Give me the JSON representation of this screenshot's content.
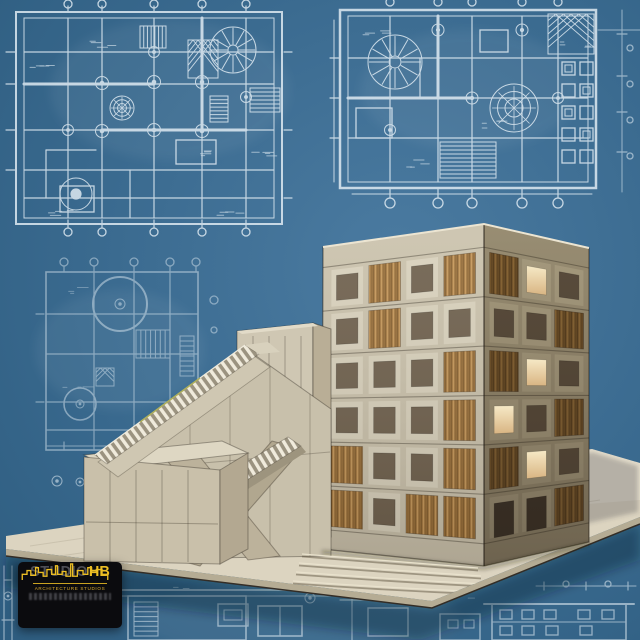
{
  "branding": {
    "studio": "STUDIO",
    "initials": "HB",
    "tagline": "ARCHITECTURE STUDIOS"
  },
  "palette": {
    "backdrop_top": "#4b7ba1",
    "backdrop_deep": "#2e5d80",
    "blueprint_line": "#e9f2f8",
    "concrete": "#d8d1bd",
    "concrete_shadow": "#a3997e",
    "wood_light": "#a5783f",
    "wood_dark": "#7d5c30",
    "window_glow": "#f0dcae",
    "base_plate": "#dcd4c0",
    "logo_yellow": "#ecbe24",
    "logo_black": "#0b0b0e"
  },
  "model": {
    "left_face_grid": [
      [
        "window",
        "louver",
        "window",
        "louver"
      ],
      [
        "window",
        "louver",
        "window",
        "window"
      ],
      [
        "window",
        "window",
        "window",
        "louver"
      ],
      [
        "window",
        "window",
        "window",
        "louver"
      ],
      [
        "louver",
        "window",
        "window",
        "louver"
      ],
      [
        "louver",
        "window",
        "louver",
        "louver"
      ]
    ],
    "right_face_grid": [
      [
        "louver",
        "glow",
        "window"
      ],
      [
        "window",
        "window",
        "louver"
      ],
      [
        "louver",
        "glow",
        "window"
      ],
      [
        "glow",
        "window",
        "louver"
      ],
      [
        "louver",
        "glow",
        "window"
      ],
      [
        "door",
        "door",
        "louver"
      ]
    ]
  },
  "blueprints": {
    "items": [
      "floor-plan-top-left",
      "floor-plan-top-right",
      "floor-plan-mid-left",
      "plan-fragments-bottom",
      "elevation-bottom-right"
    ]
  },
  "scene": {
    "description": "Architectural model of a six-storey timber-louvred tower with a crossing external stair, photographed against a blueprint backdrop."
  }
}
